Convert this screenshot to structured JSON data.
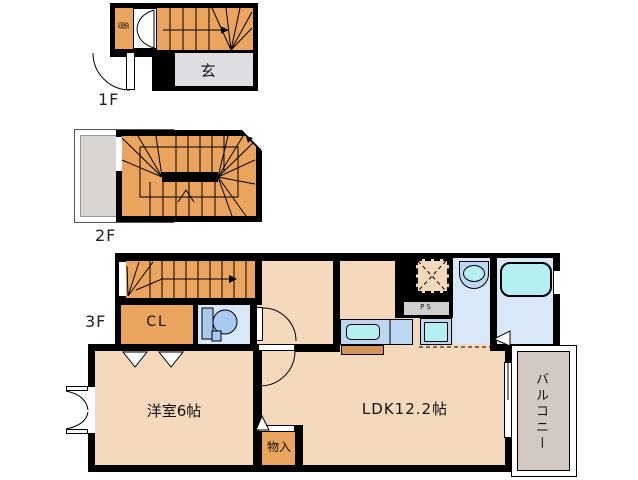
{
  "f1": {
    "label": "1F",
    "storage": "収納",
    "entrance": "玄"
  },
  "f2": {
    "label": "2F"
  },
  "f3": {
    "label": "3F",
    "closet": "CL",
    "western_room": "洋室6帖",
    "ldk": "LDK12.2帖",
    "storage": "物入",
    "pipe_space": "PS",
    "balcony": "バルコニー"
  },
  "colors": {
    "wall": "#000000",
    "stairs_orange": "#EAA45E",
    "floor_peach": "#F5D9BD",
    "entrance_gray": "#DCDEE2",
    "roof_gray": "#D9D6D2",
    "balcony_gray": "#D2CAC2",
    "wet_room_blue": "#D8E8F8",
    "fixture_blue": "#BDD7F2",
    "sink_cyan": "#B4F0F2",
    "cabinet_brown": "#D1955C"
  }
}
